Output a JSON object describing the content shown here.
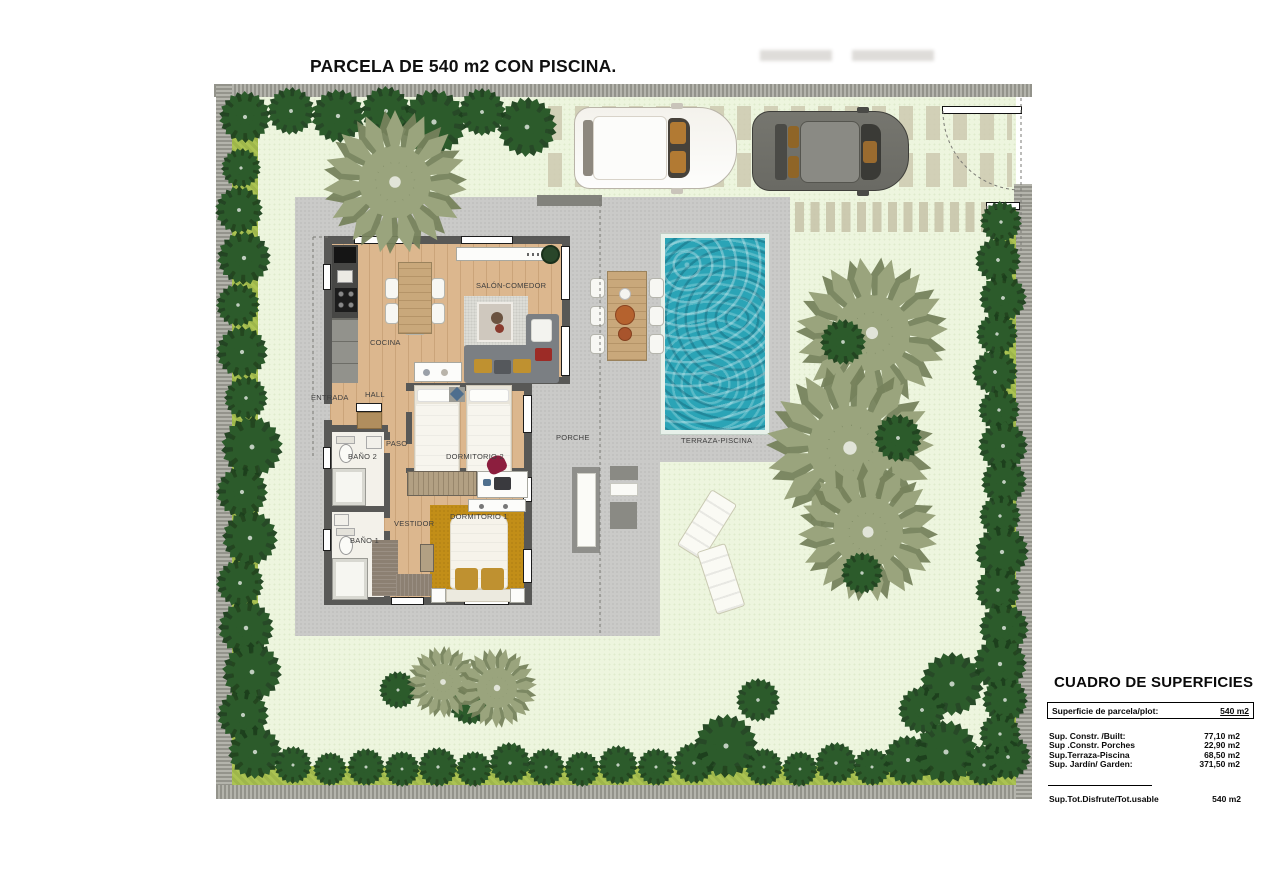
{
  "title": "PARCELA DE 540 m2 CON PISCINA.",
  "rooms": {
    "entrada": "ENTRADA",
    "hall": "HALL",
    "cocina": "COCINA",
    "salon_comedor": "SALÓN-COMEDOR",
    "paso": "PASO",
    "bano2": "BAÑO 2",
    "dormitorio2": "DORMITORIO 2",
    "vestidor": "VESTIDOR",
    "bano1": "BAÑO 1",
    "dormitorio1": "DORMITORIO 1",
    "porche": "PORCHE",
    "terraza_piscina": "TERRAZA-PISCINA"
  },
  "surfaces_table": {
    "title": "CUADRO DE SUPERFICIES",
    "plot_row": {
      "label": "Superficie de parcela/plot:",
      "value": "540 m2"
    },
    "rows": [
      {
        "label": "Sup. Constr. /Built:",
        "value": "77,10 m2"
      },
      {
        "label": "Sup .Constr. Porches",
        "value": "22,90 m2"
      },
      {
        "label": "Sup.Terraza-Piscina",
        "value": "68,50 m2"
      },
      {
        "label": "Sup. Jardín/ Garden:",
        "value": "371,50 m2"
      }
    ],
    "total_row": {
      "label": "Sup.Tot.Disfrute/Tot.usable",
      "value": "540 m2"
    }
  },
  "colors": {
    "lawn": "#edf5de",
    "hedge": "#abc352",
    "terrace": "#cacac8",
    "pool_water": "#2ba4b6",
    "pool_coping": "#e7f1ea",
    "wood_floor": "#dcb78e",
    "gold_rug": "#c28e18",
    "interior_wall": "#585856",
    "perimeter_wall": "#a4a49c",
    "tree_dark": "#2c5b2b",
    "tree_palm": "#9aa47d"
  }
}
